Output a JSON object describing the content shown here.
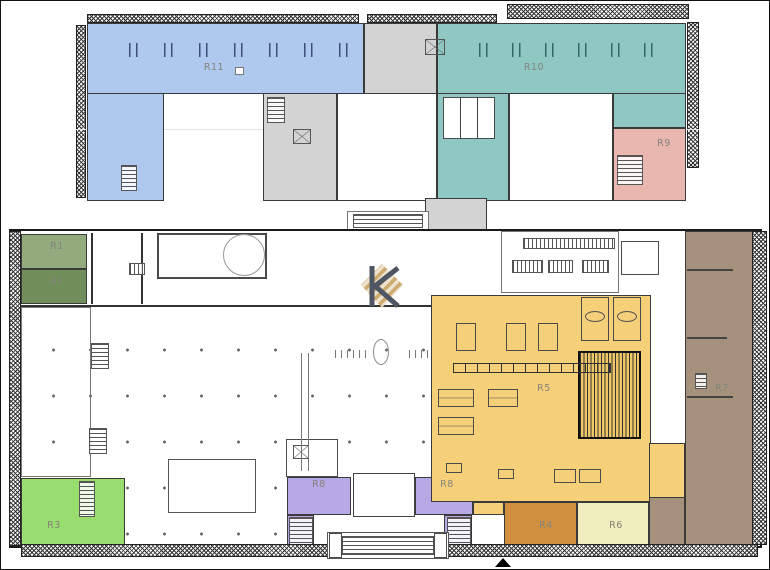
{
  "plan_name": "building-floor-plan",
  "regions": {
    "r1": {
      "label": "R1",
      "color": "#93aa7c"
    },
    "r2": {
      "label": "R2",
      "color": "#6f8e5a"
    },
    "r3": {
      "label": "R3",
      "color": "#98dd6e"
    },
    "r4": {
      "label": "R4",
      "color": "#d0903f"
    },
    "r5": {
      "label": "R5",
      "color": "#f5d079"
    },
    "r6": {
      "label": "R6",
      "color": "#efedbe"
    },
    "r7": {
      "label": "R7",
      "color": "#a5917c"
    },
    "r8": {
      "label": "R8",
      "color": "#b6a9e5"
    },
    "r9": {
      "label": "R9",
      "color": "#eab6b0"
    },
    "r10": {
      "label": "R10",
      "color": "#8fc7c3"
    },
    "r11": {
      "label": "R11",
      "color": "#afc8ee"
    }
  },
  "structure": {
    "core_gray": "#d3d3d3",
    "wall_color": "#333333",
    "label_color": "#84847c"
  },
  "logo": {
    "name": "k-monogram-logo",
    "dark": "#4f5663",
    "gold": "#c8a05e",
    "light": "#eadfc8"
  }
}
